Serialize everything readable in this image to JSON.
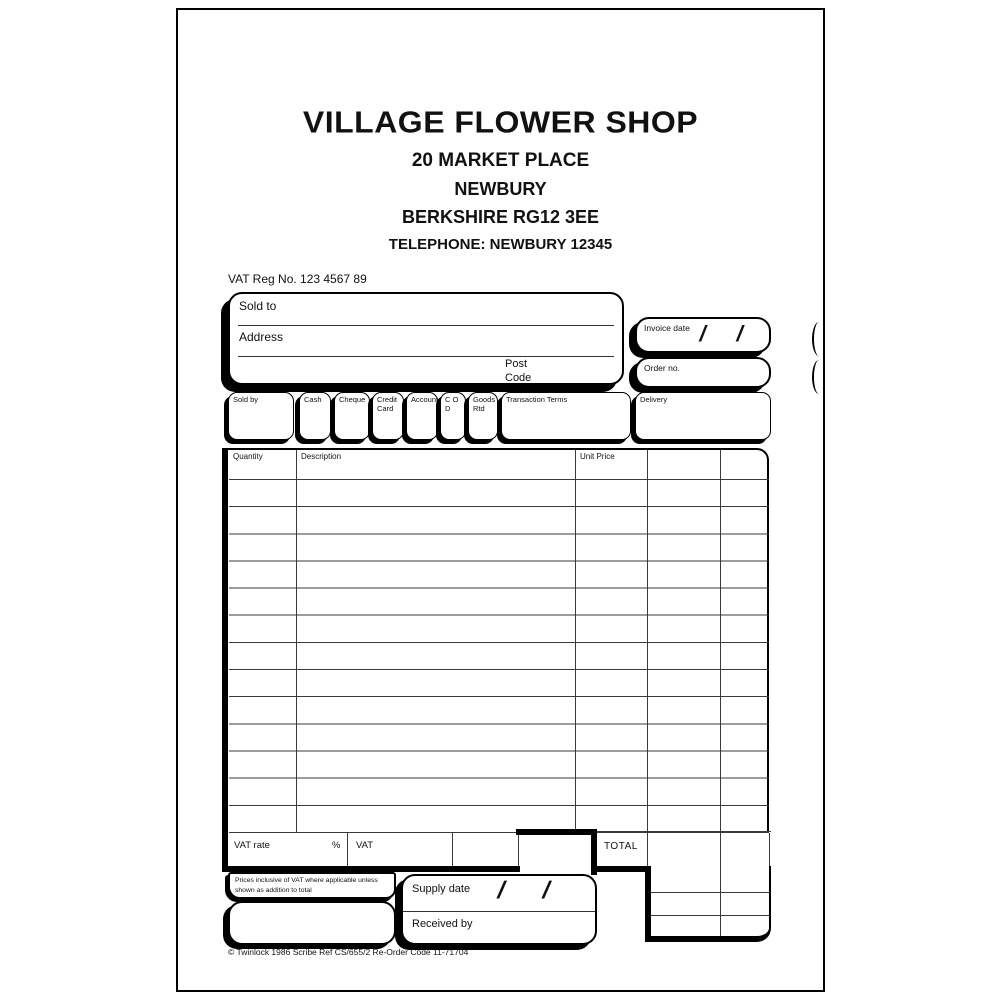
{
  "colors": {
    "ink": "#000000",
    "paper": "#ffffff",
    "grid_line": "#3a3a3a"
  },
  "header": {
    "shop_name": "VILLAGE FLOWER SHOP",
    "address_line1": "20 MARKET PLACE",
    "address_line2": "NEWBURY",
    "address_line3": "BERKSHIRE RG12 3EE",
    "telephone": "TELEPHONE: NEWBURY 12345"
  },
  "vat_reg": "VAT Reg No. 123 4567 89",
  "sold_to": {
    "sold_to_label": "Sold to",
    "address_label": "Address",
    "post_label": "Post",
    "code_label": "Code"
  },
  "invoice": {
    "invoice_date_label": "Invoice date",
    "order_no_label": "Order no.",
    "date_separator": "/"
  },
  "payment": {
    "boxes": [
      {
        "label": "Sold by"
      },
      {
        "label": "Cash"
      },
      {
        "label": "Cheque"
      },
      {
        "label": "Credit Card"
      },
      {
        "label": "Account"
      },
      {
        "label": "C O D"
      },
      {
        "label": "Goods Rtd"
      },
      {
        "label": "Transaction Terms"
      },
      {
        "label": "Delivery"
      }
    ]
  },
  "table": {
    "headers": [
      "Quantity",
      "Description",
      "Unit Price"
    ],
    "data_rows": 13,
    "rows_content": []
  },
  "totals": {
    "vat_rate_label": "VAT rate",
    "percent_label": "%",
    "vat_label": "VAT",
    "total_label": "TOTAL"
  },
  "small_print": "Prices inclusive of VAT where applicable unless shown as addition to total",
  "delivery_section": {
    "supply_date_label": "Supply date",
    "received_by_label": "Received by",
    "date_separator": "/"
  },
  "footer": {
    "imprint": "© Twinlock 1986 Scribe Ref CS/655/2 Re-Order Code 11-71704"
  }
}
